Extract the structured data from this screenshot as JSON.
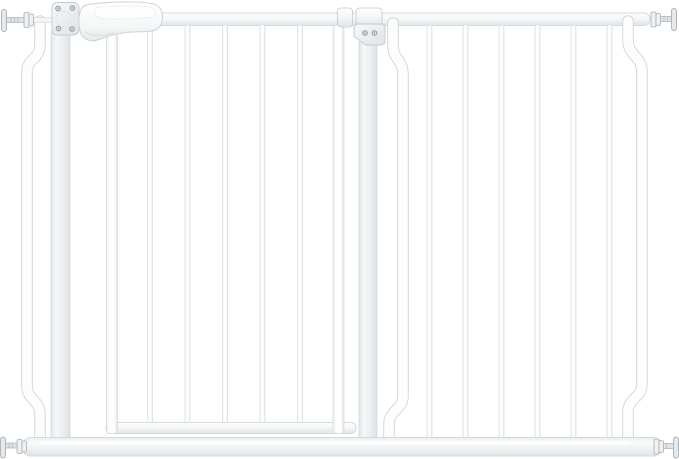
{
  "scene": {
    "description": "Product photo of a white extra-wide pressure-mounted baby safety gate: walk-through door with latch handle on the left, hinge bracket in the middle, barred extension panel on the right, and four threaded pressure-bolt spindles at the corners",
    "background": "#ffffff"
  },
  "colors": {
    "bg": "#ffffff",
    "edge": "#d4d9dc",
    "edge-soft": "#e4e8ea",
    "edge-dark": "#c3c9cd",
    "metal-white": "#fdfdfe",
    "metal-light": "#f5f7f8",
    "metal-mid": "#eceff1",
    "metal-shade": "#e1e5e8",
    "hardware": "#a9b0b5",
    "hardware-fill": "#e6e9eb",
    "screw": "#8f979c"
  },
  "layout": {
    "width": 679,
    "height": 459
  },
  "gate": {
    "top_rail": {
      "x": 55,
      "y": 13,
      "w": 595,
      "h": 12.5
    },
    "bottom_rail": {
      "x": 22,
      "y": 437.5,
      "w": 640,
      "h": 18.5
    },
    "door": {
      "bar_centers": [
        150,
        187.5,
        225,
        262.5,
        300
      ],
      "bar_width": 5,
      "bar_top": 25,
      "bar_bottom": 424,
      "left_stile": {
        "x": 106.5,
        "y": 25,
        "w": 11,
        "h": 408.5
      },
      "right_stile": {
        "x": 333,
        "y": 25,
        "w": 11,
        "h": 408.5
      },
      "bottom_rail": {
        "x": 106,
        "y": 422.5,
        "w": 250,
        "h": 11
      }
    },
    "extension": {
      "bar_centers": [
        429.5,
        465.5,
        501.5,
        537.5,
        573.5,
        609.5
      ],
      "bar_width": 5,
      "bar_top": 25,
      "bar_bottom": 440
    },
    "latch_post": {
      "x": 51,
      "y": 30,
      "w": 19,
      "h": 410
    },
    "hinge_post": {
      "x": 359,
      "y": 40,
      "w": 18,
      "h": 400
    },
    "latch_screws": [
      [
        58,
        8.5
      ],
      [
        72.5,
        8
      ],
      [
        58.5,
        28.5
      ],
      [
        72,
        29
      ]
    ],
    "hinge_screws": [
      [
        365,
        33
      ],
      [
        374.5,
        33
      ]
    ],
    "bolt_count": 4
  }
}
